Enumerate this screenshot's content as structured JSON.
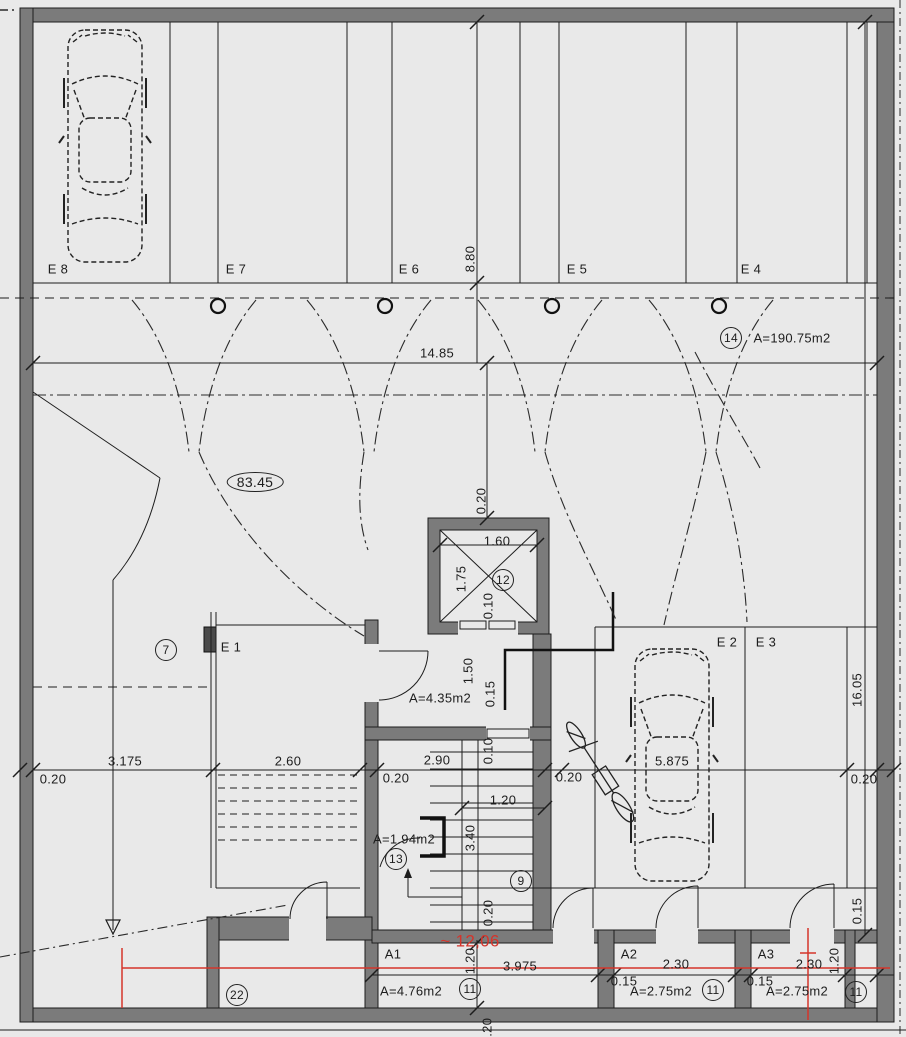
{
  "drawing": {
    "kind": "architectural floor plan - underground parking level",
    "background_color": "#e9e9e9",
    "wall_color": "#7b7b7b",
    "line_color": "#1d1d1d",
    "red_color": "#d5342b",
    "garage_area": "A=190.75m2",
    "ramp_level": "83.45",
    "red_annotation": "~ 12,06",
    "parking_spots": [
      "E 8",
      "E 7",
      "E 6",
      "E 5",
      "E 4",
      "E 1",
      "E 2",
      "E 3"
    ],
    "storage_rooms": [
      {
        "name": "A1",
        "area": "A=4.76m2",
        "width": "3.975",
        "depth": "1.20"
      },
      {
        "name": "A2",
        "area": "A=2.75m2",
        "width": "2.30",
        "wall": "0.15"
      },
      {
        "name": "A3",
        "area": "A=2.75m2",
        "width": "2.30",
        "depth": "1.20",
        "wall": "0.15"
      }
    ],
    "lobby_area": "A=4.35m2",
    "closet_area": "A=1.94m2",
    "overall_dims": {
      "width": "14.85",
      "height": "16.05",
      "bay_depth": "8.80"
    }
  },
  "labels": [
    {
      "name": "spot-label-e8",
      "text": "E 8",
      "x": 58,
      "y": 269
    },
    {
      "name": "spot-label-e7",
      "text": "E 7",
      "x": 236,
      "y": 269
    },
    {
      "name": "spot-label-e6",
      "text": "E 6",
      "x": 409,
      "y": 269
    },
    {
      "name": "spot-label-e5",
      "text": "E 5",
      "x": 577,
      "y": 269
    },
    {
      "name": "spot-label-e4",
      "text": "E 4",
      "x": 751,
      "y": 269
    },
    {
      "name": "spot-label-e1",
      "text": "E 1",
      "x": 231,
      "y": 647
    },
    {
      "name": "spot-label-e2",
      "text": "E 2",
      "x": 727,
      "y": 642
    },
    {
      "name": "spot-label-e3",
      "text": "E 3",
      "x": 766,
      "y": 642
    },
    {
      "name": "dim-14-85",
      "text": "14.85",
      "x": 437,
      "y": 353
    },
    {
      "name": "dim-8-80",
      "text": "8.80",
      "x": 470,
      "y": 259,
      "rot": 1
    },
    {
      "name": "dim-0-20-elevtop",
      "text": "0.20",
      "x": 481,
      "y": 501,
      "rot": 1
    },
    {
      "name": "dim-1-60",
      "text": "1.60",
      "x": 497,
      "y": 541
    },
    {
      "name": "dim-1-75",
      "text": "1.75",
      "x": 461,
      "y": 579,
      "rot": 1
    },
    {
      "name": "dim-0-10-elev",
      "text": "0.10",
      "x": 488,
      "y": 606,
      "rot": 1
    },
    {
      "name": "dim-1-50",
      "text": "1.50",
      "x": 468,
      "y": 671,
      "rot": 1
    },
    {
      "name": "dim-0-15-lobby",
      "text": "0.15",
      "x": 490,
      "y": 694,
      "rot": 1
    },
    {
      "name": "dim-0-10-stair",
      "text": "0.10",
      "x": 488,
      "y": 751,
      "rot": 1
    },
    {
      "name": "dim-0-20-left",
      "text": "0.20",
      "x": 53,
      "y": 779
    },
    {
      "name": "dim-3-175",
      "text": "3.175",
      "x": 125,
      "y": 761
    },
    {
      "name": "dim-2-60",
      "text": "2.60",
      "x": 288,
      "y": 761
    },
    {
      "name": "dim-0-20-core-left",
      "text": "0.20",
      "x": 396,
      "y": 778
    },
    {
      "name": "dim-2-90",
      "text": "2.90",
      "x": 437,
      "y": 760
    },
    {
      "name": "dim-0-20-core-right",
      "text": "0.20",
      "x": 569,
      "y": 777
    },
    {
      "name": "dim-5-875",
      "text": "5.875",
      "x": 672,
      "y": 761
    },
    {
      "name": "dim-0-20-right",
      "text": "0.20",
      "x": 864,
      "y": 779
    },
    {
      "name": "dim-16-05",
      "text": "16.05",
      "x": 857,
      "y": 690,
      "rot": 1
    },
    {
      "name": "dim-1-20-stair",
      "text": "1.20",
      "x": 503,
      "y": 800
    },
    {
      "name": "dim-3-40",
      "text": "3.40",
      "x": 470,
      "y": 838,
      "rot": 1
    },
    {
      "name": "dim-0-20-stair-bottom",
      "text": "0.20",
      "x": 488,
      "y": 913,
      "rot": 1
    },
    {
      "name": "dim-3-975",
      "text": "3.975",
      "x": 520,
      "y": 966
    },
    {
      "name": "dim-1-20-a1",
      "text": "1.20",
      "x": 470,
      "y": 961,
      "rot": 1
    },
    {
      "name": "dim-2-30-a2",
      "text": "2.30",
      "x": 676,
      "y": 964
    },
    {
      "name": "dim-0-15-a2",
      "text": "0.15",
      "x": 624,
      "y": 981
    },
    {
      "name": "dim-2-30-a3",
      "text": "2.30",
      "x": 809,
      "y": 964
    },
    {
      "name": "dim-0-15-a3",
      "text": "0.15",
      "x": 760,
      "y": 981
    },
    {
      "name": "dim-1-20-a3",
      "text": "1.20",
      "x": 834,
      "y": 961,
      "rot": 1
    },
    {
      "name": "dim-0-15-right",
      "text": "0.15",
      "x": 857,
      "y": 911,
      "rot": 1
    },
    {
      "name": "dim-0-20-bottom",
      "text": "0.20",
      "x": 487,
      "y": 1031,
      "rot": 1
    },
    {
      "name": "area-garage",
      "text": "A=190.75m2",
      "x": 792,
      "y": 338
    },
    {
      "name": "area-lobby",
      "text": "A=4.35m2",
      "x": 440,
      "y": 698
    },
    {
      "name": "area-closet",
      "text": "A=1.94m2",
      "x": 404,
      "y": 839
    },
    {
      "name": "area-a1",
      "text": "A=4.76m2",
      "x": 411,
      "y": 991
    },
    {
      "name": "area-a2",
      "text": "A=2.75m2",
      "x": 661,
      "y": 991
    },
    {
      "name": "area-a3",
      "text": "A=2.75m2",
      "x": 797,
      "y": 991
    },
    {
      "name": "room-label-a1",
      "text": "A1",
      "x": 393,
      "y": 954
    },
    {
      "name": "room-label-a2",
      "text": "A2",
      "x": 629,
      "y": 954
    },
    {
      "name": "room-label-a3",
      "text": "A3",
      "x": 766,
      "y": 954
    },
    {
      "name": "ramp-level-83-45",
      "text": "83.45",
      "x": 255,
      "y": 482,
      "cls": "ellipse"
    },
    {
      "name": "red-annotation-12-06",
      "text": "~ 12,06",
      "x": 470,
      "y": 941,
      "cls": "red"
    },
    {
      "name": "tag-circle-7",
      "text": "7",
      "x": 166,
      "y": 650,
      "cls": "circled"
    },
    {
      "name": "tag-circle-9",
      "text": "9",
      "x": 521,
      "y": 881,
      "cls": "circled"
    },
    {
      "name": "tag-circle-11-a1",
      "text": "11",
      "x": 470,
      "y": 989,
      "cls": "circled"
    },
    {
      "name": "tag-circle-11-a2",
      "text": "11",
      "x": 713,
      "y": 990,
      "cls": "circled"
    },
    {
      "name": "tag-circle-11-a3",
      "text": "11",
      "x": 856,
      "y": 992,
      "cls": "circled"
    },
    {
      "name": "tag-circle-12",
      "text": "12",
      "x": 503,
      "y": 580,
      "cls": "circled"
    },
    {
      "name": "tag-circle-13",
      "text": "13",
      "x": 396,
      "y": 859,
      "cls": "circled"
    },
    {
      "name": "tag-circle-14",
      "text": "14",
      "x": 731,
      "y": 338,
      "cls": "circled"
    },
    {
      "name": "tag-circle-22",
      "text": "22",
      "x": 237,
      "y": 995,
      "cls": "circled"
    }
  ]
}
